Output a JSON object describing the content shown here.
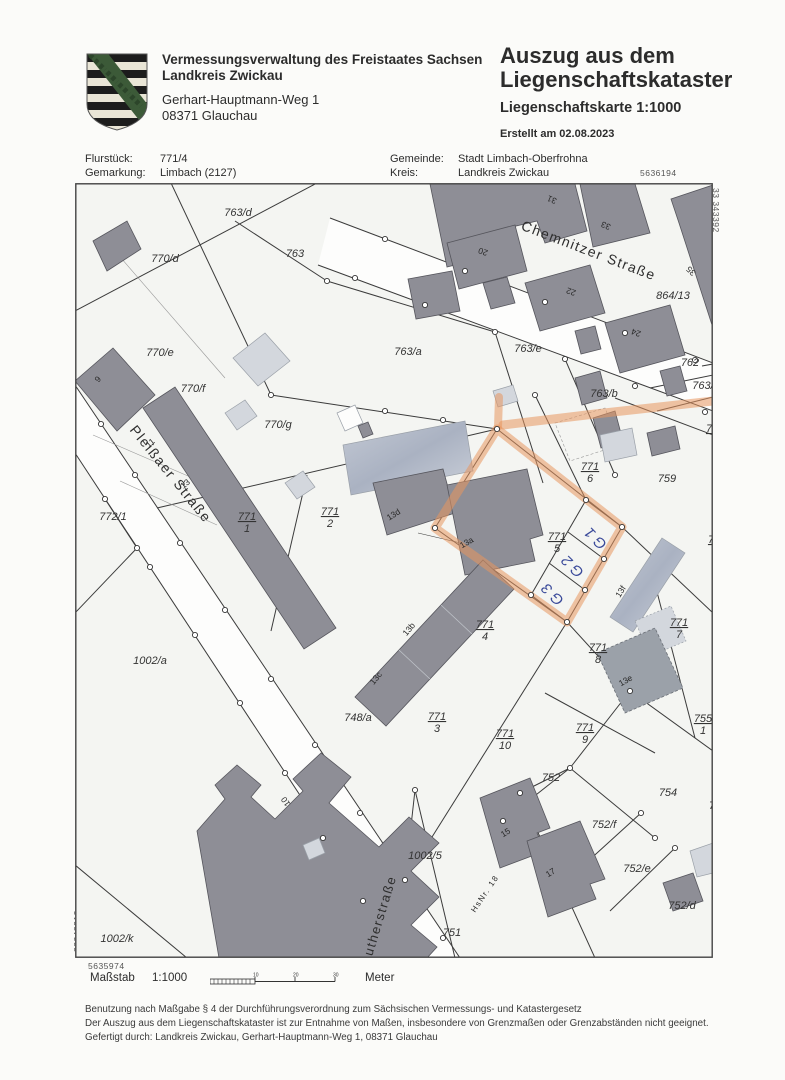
{
  "header": {
    "org_line1": "Vermessungsverwaltung des Freistaates Sachsen",
    "org_line2": "Landkreis Zwickau",
    "address_line1": "Gerhart-Hauptmann-Weg 1",
    "address_line2": "08371 Glauchau",
    "title_line1": "Auszug aus dem",
    "title_line2": "Liegenschaftskataster",
    "subtitle": "Liegenschaftskarte  1:1000",
    "created": "Erstellt am 02.08.2023"
  },
  "info": {
    "flurstueck_label": "Flurstück:",
    "flurstueck_value": "771/4",
    "gemarkung_label": "Gemarkung:",
    "gemarkung_value": "Limbach (2127)",
    "gemeinde_label": "Gemeinde:",
    "gemeinde_value": "Stadt Limbach-Oberfrohna",
    "kreis_label": "Kreis:",
    "kreis_value": "Landkreis Zwickau"
  },
  "map": {
    "edge_coords": {
      "top_right": "5636194",
      "right_vertical": "33 343392",
      "left_vertical": "33343212",
      "bottom_left": "5635974"
    },
    "streets": [
      {
        "text": "Chemnitzer Straße",
        "x": 512,
        "y": 72,
        "rot": 21,
        "size": 14
      },
      {
        "text": "Pleißaer Straße",
        "x": 92,
        "y": 294,
        "rot": 51,
        "size": 14
      },
      {
        "text": "Lutherstraße",
        "x": 308,
        "y": 738,
        "rot": -73,
        "size": 13
      },
      {
        "text": "HsNr. 18",
        "x": 412,
        "y": 712,
        "rot": -56,
        "size": 8
      }
    ],
    "parcel_labels": [
      {
        "text": "763/d",
        "x": 163,
        "y": 33
      },
      {
        "text": "770/d",
        "x": 90,
        "y": 79
      },
      {
        "text": "763",
        "x": 220,
        "y": 74
      },
      {
        "text": "770/e",
        "x": 85,
        "y": 173
      },
      {
        "text": "770/f",
        "x": 118,
        "y": 209
      },
      {
        "text": "770/g",
        "x": 203,
        "y": 245
      },
      {
        "text": "772/1",
        "x": 38,
        "y": 337
      },
      {
        "text": "1002/a",
        "x": 75,
        "y": 481
      },
      {
        "text": "748/a",
        "x": 283,
        "y": 538
      },
      {
        "text": "1002/5",
        "x": 350,
        "y": 676
      },
      {
        "text": "751",
        "x": 377,
        "y": 753
      },
      {
        "text": "1002/k",
        "x": 42,
        "y": 759
      },
      {
        "text": "763/a",
        "x": 333,
        "y": 172
      },
      {
        "text": "763/e",
        "x": 453,
        "y": 169
      },
      {
        "text": "763/b",
        "x": 529,
        "y": 214
      },
      {
        "text": "864/13",
        "x": 598,
        "y": 116
      },
      {
        "text": "759",
        "x": 592,
        "y": 299
      },
      {
        "text": "762",
        "x": 615,
        "y": 183
      },
      {
        "text": "763/",
        "x": 628,
        "y": 206
      },
      {
        "text": "752",
        "x": 476,
        "y": 598
      },
      {
        "text": "754",
        "x": 593,
        "y": 613
      },
      {
        "text": "752/f",
        "x": 529,
        "y": 645
      },
      {
        "text": "752/e",
        "x": 562,
        "y": 689
      },
      {
        "text": "752/d",
        "x": 607,
        "y": 726
      },
      {
        "text": "753",
        "x": 643,
        "y": 626
      }
    ],
    "fraction_labels": [
      {
        "num": "771",
        "den": "1",
        "x": 172,
        "y": 337
      },
      {
        "num": "771",
        "den": "2",
        "x": 255,
        "y": 332
      },
      {
        "num": "771",
        "den": "6",
        "x": 515,
        "y": 287
      },
      {
        "num": "771",
        "den": "5",
        "x": 482,
        "y": 357
      },
      {
        "num": "771",
        "den": "4",
        "x": 410,
        "y": 445
      },
      {
        "num": "771",
        "den": "3",
        "x": 362,
        "y": 537
      },
      {
        "num": "771",
        "den": "10",
        "x": 430,
        "y": 554
      },
      {
        "num": "771",
        "den": "8",
        "x": 523,
        "y": 468
      },
      {
        "num": "771",
        "den": "9",
        "x": 510,
        "y": 548
      },
      {
        "num": "771",
        "den": "7",
        "x": 604,
        "y": 443
      },
      {
        "num": "755",
        "den": "1",
        "x": 628,
        "y": 539
      },
      {
        "num": "7",
        "den": "",
        "x": 634,
        "y": 249
      },
      {
        "num": "7",
        "den": "",
        "x": 636,
        "y": 360
      }
    ],
    "house_numbers": [
      {
        "text": "31",
        "x": 478,
        "y": 14,
        "rot": 203
      },
      {
        "text": "33",
        "x": 532,
        "y": 40,
        "rot": 203
      },
      {
        "text": "35",
        "x": 618,
        "y": 86,
        "rot": 225
      },
      {
        "text": "20",
        "x": 409,
        "y": 66,
        "rot": 200
      },
      {
        "text": "22",
        "x": 497,
        "y": 106,
        "rot": 200
      },
      {
        "text": "24",
        "x": 562,
        "y": 147,
        "rot": 200
      },
      {
        "text": "9",
        "x": 25,
        "y": 198,
        "rot": -50
      },
      {
        "text": "11",
        "x": 77,
        "y": 262,
        "rot": -40
      },
      {
        "text": "13",
        "x": 112,
        "y": 303,
        "rot": -40
      },
      {
        "text": "13d",
        "x": 320,
        "y": 334,
        "rot": -32
      },
      {
        "text": "13a",
        "x": 393,
        "y": 362,
        "rot": -30
      },
      {
        "text": "13b",
        "x": 336,
        "y": 448,
        "rot": -50
      },
      {
        "text": "13c",
        "x": 303,
        "y": 497,
        "rot": -50
      },
      {
        "text": "13e",
        "x": 552,
        "y": 500,
        "rot": -30
      },
      {
        "text": "13f",
        "x": 548,
        "y": 410,
        "rot": -58
      },
      {
        "text": "10",
        "x": 213,
        "y": 617,
        "rot": -125
      },
      {
        "text": "15",
        "x": 432,
        "y": 652,
        "rot": -32
      },
      {
        "text": "17",
        "x": 477,
        "y": 692,
        "rot": -32
      }
    ],
    "handwritten": [
      {
        "text": "G 1",
        "x": 524,
        "y": 352,
        "rot": 225
      },
      {
        "text": "G 2",
        "x": 501,
        "y": 380,
        "rot": 225
      },
      {
        "text": "G 3",
        "x": 481,
        "y": 408,
        "rot": 225
      }
    ],
    "highlight_color": "#e8965f",
    "handwriting_color": "#3a4a9a"
  },
  "scalebar": {
    "label": "Maßstab",
    "scale": "1:1000",
    "unit": "Meter",
    "ticks": [
      "10",
      "20",
      "30"
    ]
  },
  "footer": {
    "line1": "Benutzung nach Maßgabe § 4 der Durchführungsverordnung zum Sächsischen Vermessungs- und Katastergesetz",
    "line2": "Der Auszug aus dem Liegenschaftskataster ist zur Entnahme von Maßen, insbesondere von Grenzmaßen oder Grenzabständen nicht geeignet.",
    "line3": "Gefertigt durch: Landkreis Zwickau, Gerhart-Hauptmann-Weg 1, 08371 Glauchau"
  }
}
